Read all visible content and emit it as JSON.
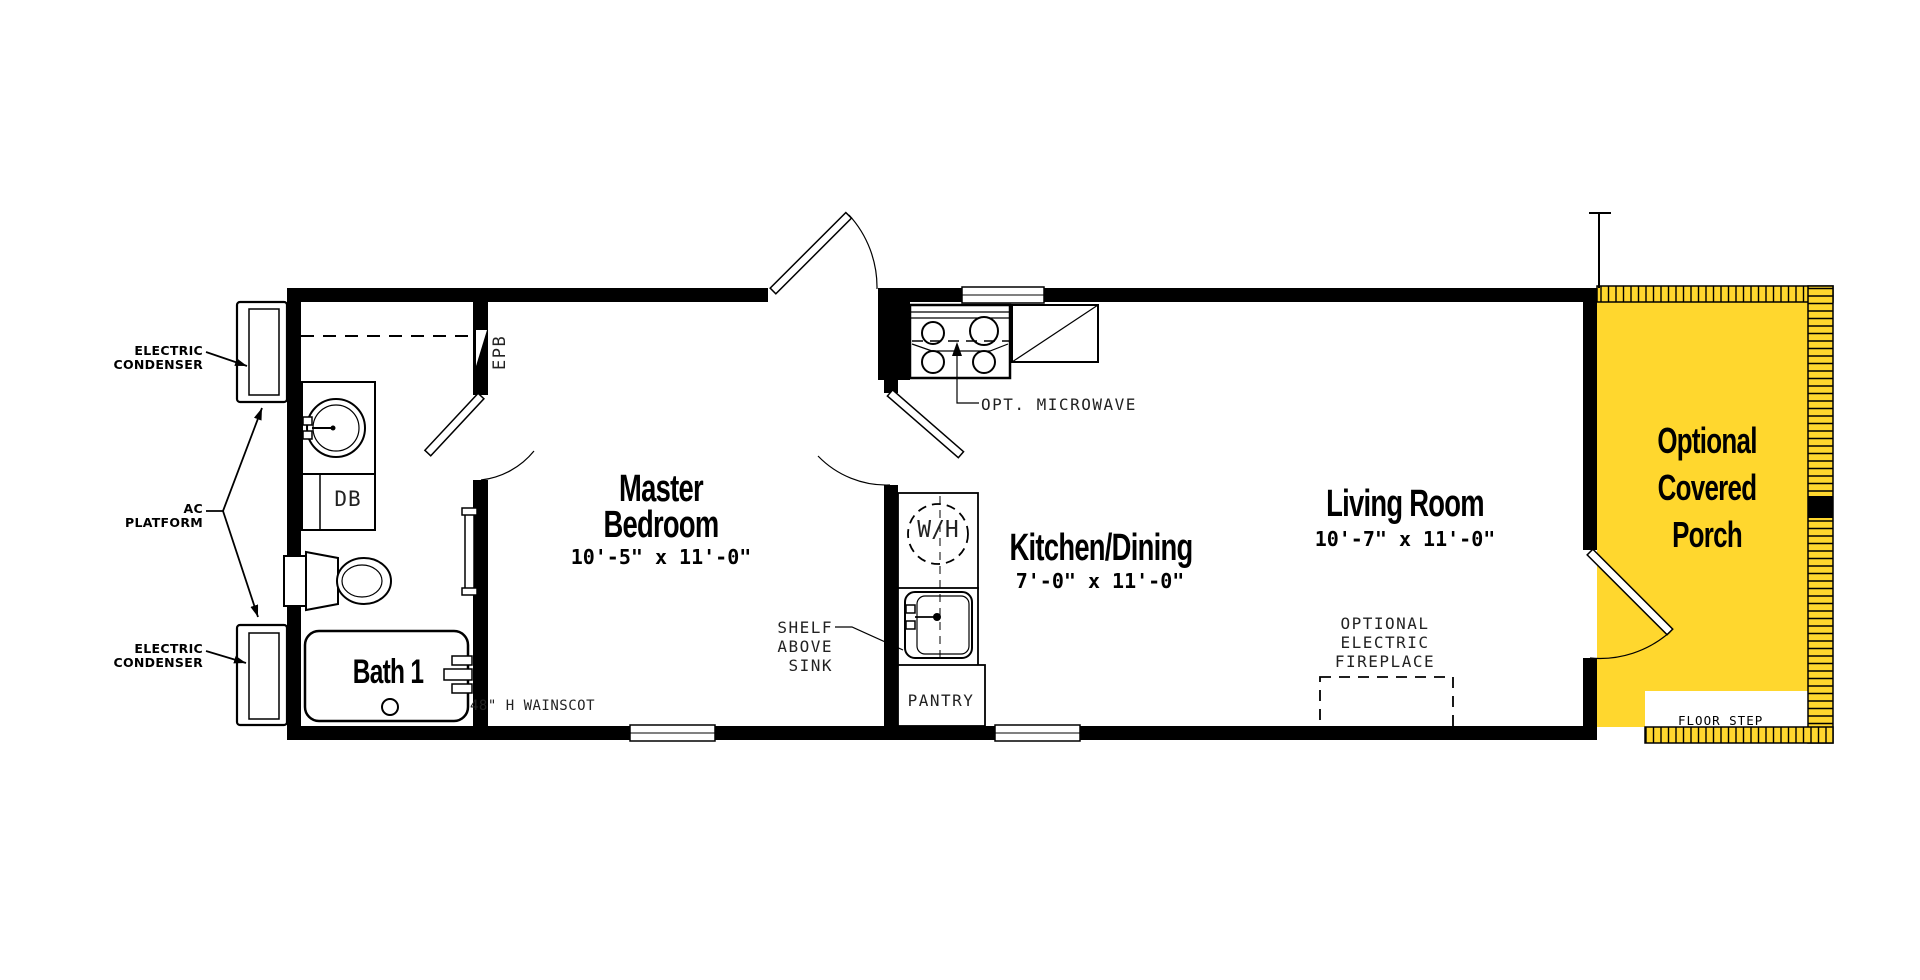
{
  "plan": {
    "background_color": "#ffffff",
    "wall_color": "#000000",
    "porch_color": "#FFD72E"
  },
  "rooms": {
    "master_bedroom": {
      "name": "Master\nBedroom",
      "dims": "10'-5\" x 11'-0\""
    },
    "kitchen_dining": {
      "name": "Kitchen/Dining",
      "dims": "7'-0\" x 11'-0\""
    },
    "living_room": {
      "name": "Living Room",
      "dims": "10'-7\" x 11'-0\""
    },
    "bath": {
      "name": "Bath 1"
    },
    "porch": {
      "name": "Optional\nCovered\nPorch"
    }
  },
  "labels": {
    "electric_condenser_top": "ELECTRIC\nCONDENSER",
    "ac_platform": "AC\nPLATFORM",
    "electric_condenser_bottom": "ELECTRIC\nCONDENSER",
    "epb": "EPB",
    "db": "DB",
    "wh": "W/H",
    "opt_microwave": "OPT. MICROWAVE",
    "shelf_above_sink": "SHELF\nABOVE\nSINK",
    "pantry": "PANTRY",
    "wainscot": "48\" H WAINSCOT",
    "optional_electric_fireplace": "OPTIONAL\nELECTRIC\nFIREPLACE",
    "floor_step": "FLOOR STEP"
  }
}
